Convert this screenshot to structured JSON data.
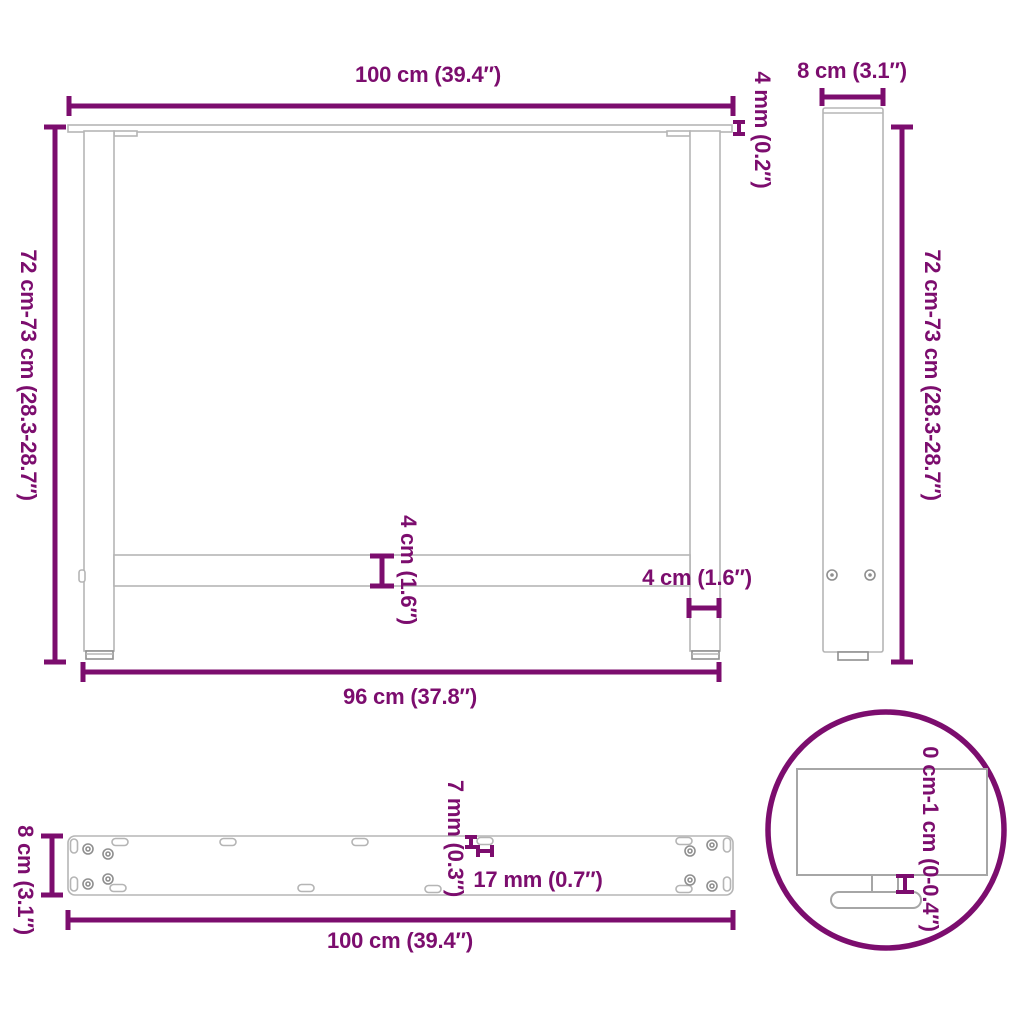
{
  "colors": {
    "accent": "#7C0D6E",
    "outline_light": "#B5B5B5",
    "outline_dark": "#8F8F8F"
  },
  "labels": {
    "front": {
      "top_width": "100 cm (39.4″)",
      "plate_thickness": "4 mm (0.2″)",
      "height_range": "72 cm-73 cm (28.3-28.7″)",
      "crossbar_thickness": "4 cm (1.6″)",
      "leg_width": "4 cm (1.6″)",
      "bottom_width": "96 cm (37.8″)"
    },
    "side": {
      "depth": "8 cm (3.1″)",
      "height_range": "72 cm-73 cm (28.3-28.7″)"
    },
    "plate": {
      "depth": "8 cm (3.1″)",
      "hole_size": "7 mm (0.3″)",
      "slot_length": "17 mm (0.7″)",
      "width": "100 cm (39.4″)"
    },
    "detail": {
      "adjustable_height": "0 cm-1 cm (0-0.4″)"
    }
  }
}
